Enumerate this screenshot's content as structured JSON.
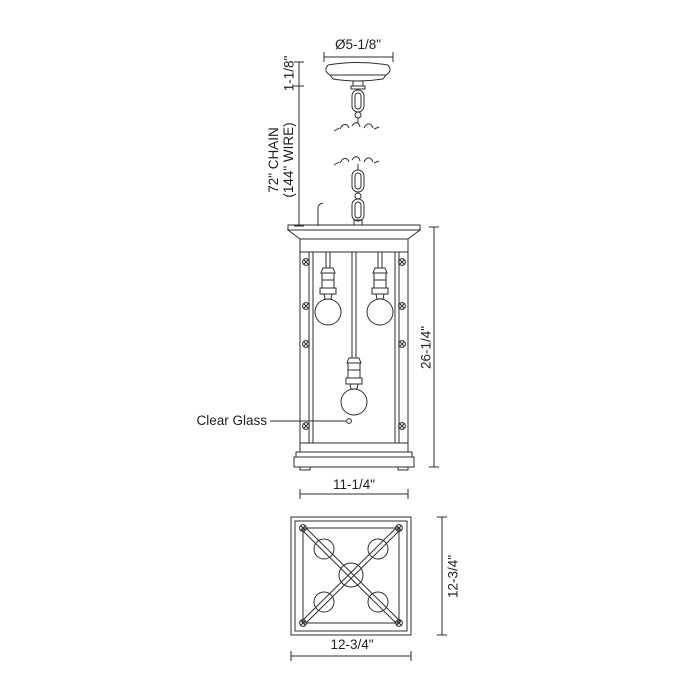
{
  "labels": {
    "canopy_diameter": "Ø5-1/8\"",
    "canopy_height": "1-1/8\"",
    "chain_length_line1": "72\" CHAIN",
    "chain_length_line2": "(144\" WIRE)",
    "fixture_height": "26-1/4\"",
    "fixture_width": "11-1/4\"",
    "clear_glass": "Clear Glass",
    "bottom_view_height": "12-3/4\"",
    "bottom_view_width": "12-3/4\""
  },
  "colors": {
    "line": "#2e2e2e",
    "background": "#ffffff"
  }
}
